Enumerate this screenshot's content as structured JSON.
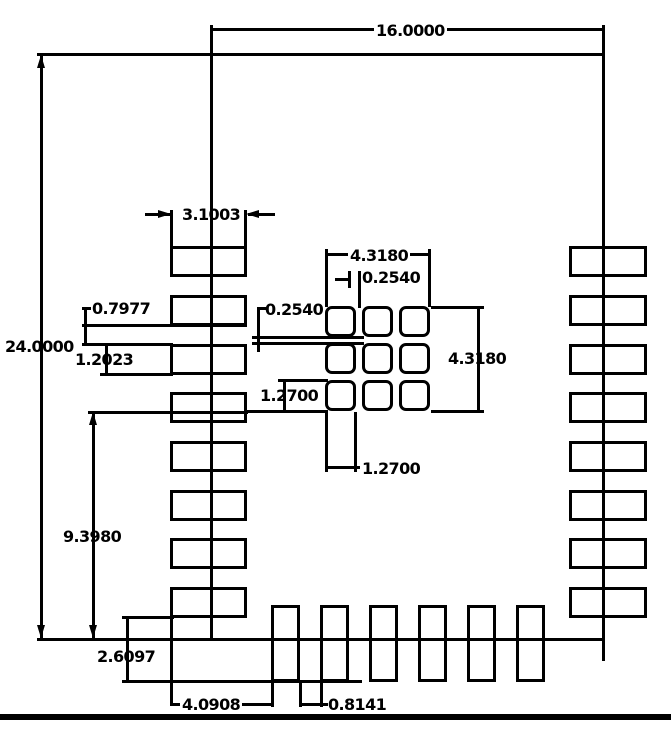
{
  "drawing": {
    "title": "PCB module land pattern dimension drawing",
    "units": "mm",
    "stroke_color": "#000000",
    "background_color": "#ffffff"
  },
  "labels": {
    "d16": "16.0000",
    "d24": "24.0000",
    "d31003": "3.1003",
    "d07977": "0.7977",
    "d12023": "1.2023",
    "d02540L": "0.2540",
    "d43180T": "4.3180",
    "d02540T": "0.2540",
    "d43180R": "4.3180",
    "d12700L": "1.2700",
    "d12700B": "1.2700",
    "d93980": "9.3980",
    "d26097": "2.6097",
    "d40908": "4.0908",
    "d08141": "0.8141"
  },
  "footprint": {
    "board_outline": {
      "width_mm": "16.0000",
      "height_mm": "24.0000"
    },
    "side_pads": {
      "count_left": 8,
      "count_right": 8,
      "pad_width_mm": "3.1003",
      "pad_height_mm": "1.2023",
      "pad_gap_mm": "0.7977",
      "left_column_lower_span_mm": "9.3980"
    },
    "bottom_pads": {
      "count": 6,
      "gap_mm": "0.8141",
      "offset_from_left_pads_mm": "4.0908",
      "overhang_below_outline_mm": "2.6097"
    },
    "thermal_grid": {
      "rows": 3,
      "cols": 3,
      "pad_size_mm": "1.2700",
      "pad_gap_mm": "0.2540",
      "span_mm": "4.3180"
    }
  },
  "geometry": {
    "board_lines": [
      [
        37,
        53,
        568,
        3
      ],
      [
        37,
        638,
        568,
        3
      ],
      [
        210,
        25,
        3,
        615
      ],
      [
        602,
        25,
        3,
        636
      ]
    ],
    "frame_lines": [
      [
        0,
        714,
        671,
        6
      ]
    ],
    "dim_lines": [
      [
        212,
        28,
        391,
        3
      ],
      [
        40,
        55,
        3,
        584
      ],
      [
        170,
        210,
        3,
        38
      ],
      [
        244,
        210,
        3,
        38
      ],
      [
        145,
        213,
        26,
        3
      ],
      [
        248,
        213,
        27,
        3
      ],
      [
        82,
        324,
        165,
        3
      ],
      [
        82,
        343,
        91,
        3
      ],
      [
        84,
        307,
        3,
        39
      ],
      [
        82,
        307,
        9,
        3
      ],
      [
        100,
        373,
        73,
        3
      ],
      [
        105,
        343,
        3,
        33
      ],
      [
        257,
        307,
        9,
        3
      ],
      [
        257,
        307,
        3,
        45
      ],
      [
        252,
        336,
        112,
        3
      ],
      [
        252,
        342,
        112,
        3
      ],
      [
        325,
        249,
        3,
        58
      ],
      [
        428,
        249,
        3,
        58
      ],
      [
        325,
        253,
        106,
        3
      ],
      [
        335,
        278,
        16,
        3
      ],
      [
        348,
        271,
        3,
        17
      ],
      [
        358,
        271,
        3,
        37
      ],
      [
        431,
        306,
        53,
        3
      ],
      [
        431,
        410,
        53,
        3
      ],
      [
        477,
        306,
        3,
        107
      ],
      [
        278,
        379,
        50,
        3
      ],
      [
        245,
        410,
        83,
        3
      ],
      [
        283,
        379,
        3,
        34
      ],
      [
        325,
        412,
        3,
        60
      ],
      [
        354,
        412,
        3,
        60
      ],
      [
        326,
        466,
        34,
        3
      ],
      [
        88,
        411,
        160,
        3
      ],
      [
        92,
        412,
        3,
        228
      ],
      [
        122,
        616,
        52,
        3
      ],
      [
        122,
        680,
        240,
        3
      ],
      [
        126,
        616,
        3,
        67
      ],
      [
        170,
        617,
        3,
        89
      ],
      [
        271,
        682,
        3,
        25
      ],
      [
        171,
        703,
        102,
        3
      ],
      [
        299,
        682,
        3,
        25
      ],
      [
        320,
        682,
        3,
        25
      ],
      [
        302,
        703,
        26,
        3
      ]
    ],
    "arrows": [
      [
        41,
        55,
        "up"
      ],
      [
        41,
        638,
        "down"
      ],
      [
        93,
        412,
        "up"
      ],
      [
        93,
        638,
        "down"
      ],
      [
        171,
        214,
        "right"
      ],
      [
        246,
        214,
        "left"
      ]
    ],
    "side_pad_tops": [
      246,
      295,
      344,
      392,
      441,
      490,
      538,
      587
    ],
    "left_pads": {
      "x": 170,
      "w": 77,
      "h": 31
    },
    "right_pads": {
      "x": 569,
      "w": 78,
      "h": 31
    },
    "bottom_pads": {
      "lefts": [
        271,
        320,
        369,
        418,
        467,
        516
      ],
      "y": 605,
      "w": 29,
      "h": 77
    },
    "thermal": {
      "cols": [
        325,
        362,
        399
      ],
      "rows": [
        306,
        343,
        380
      ],
      "size": 31
    }
  }
}
